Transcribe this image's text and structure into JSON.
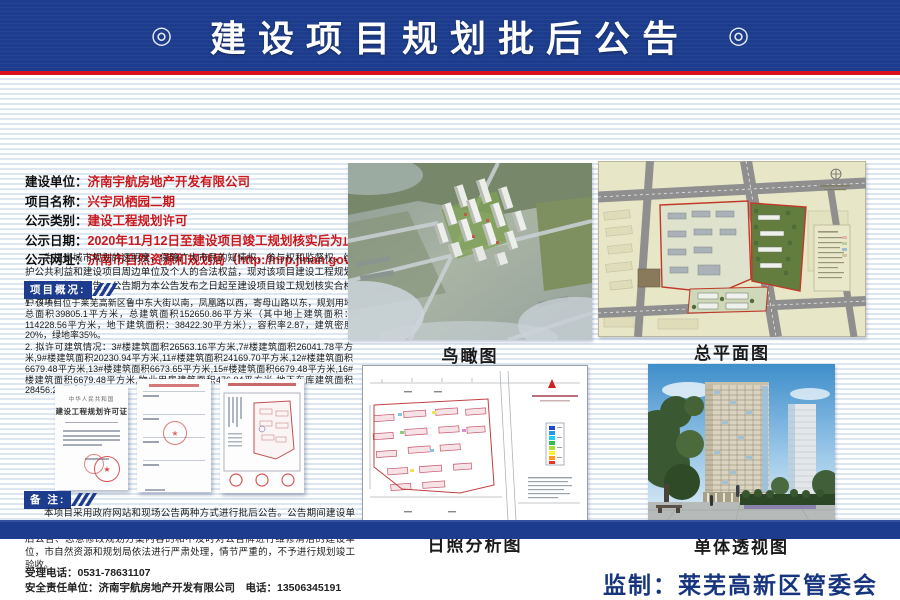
{
  "header": {
    "title": "建设项目规划批后公告",
    "ornament_left": "◎",
    "ornament_right": "◎"
  },
  "info": {
    "rows": [
      {
        "label": "建设单位：",
        "value": "济南宇航房地产开发有限公司"
      },
      {
        "label": "项目名称：",
        "value": "兴宇凤栖园二期"
      },
      {
        "label": "公示类别：",
        "value": "建设工程规划许可"
      },
      {
        "label": "公示日期：",
        "value": "2020年11月12日至建设项目竣工规划核实后为止"
      },
      {
        "label": "公示网址：",
        "value": "济南市自然资源和规划局（http://nrp.jinan.gov.cn）"
      }
    ],
    "intro": "为提高城市规划的透明度，保障广大市民的知情权，参与权和监督权，维护公共利益和建设项目周边单位及个人的合法权益，现对该项目建设工程规划许可进行批后公告，公告期为本公告发布之日起至建设项目竣工规划核实合格后为止。"
  },
  "overview": {
    "heading": "项目概况:",
    "item1": "1. 该项目位于莱芜高新区鲁中东大街以南，凤凰路以西，寄母山路以东，规划用地总面积39805.1平方米，总建筑面积152650.86平方米（其中地上建筑面积：114228.56平方米，地下建筑面积：38422.30平方米），容积率2.87，建筑密度20%，绿地率35%。",
    "item2": "2. 拟许可建筑情况：3#楼建筑面积26563.16平方米,7#楼建筑面积26041.78平方米,9#楼建筑面积20230.94平方米,11#楼建筑面积24169.70平方米,12#楼建筑面积6679.48平方米,13#楼建筑面积6673.65平方米,15#楼建筑面积6679.48平方米,16#楼建筑面积6679.48平方米,物业用房建筑面积476.94平方米,地下车库建筑面积28456.25平方米。"
  },
  "permits": {
    "cert_country": "中华人民共和国",
    "cert_title": "建设工程规划许可证"
  },
  "remarks": {
    "heading": "备 注:",
    "text": "本项目采用政府网站和现场公告两种方式进行批后公告。公告期间建设单位应保留公告牌清洁、完整，如有损坏应及时更换。对凡是不按照规定进行批后公告、恶意修改规划方案内容的和不及时对公告牌进行维修清洁的建设单位，市自然资源和规划局依法进行严肃处理，情节严重的，不予进行规划竣工验收。"
  },
  "contact": {
    "tel_line": "受理电话：0531-78631107",
    "safety_line": "安全责任单位：济南宇航房地产开发有限公司　电话：13506345191"
  },
  "figures": {
    "aerial_caption": "鸟瞰图",
    "siteplan_caption": "总平面图",
    "sunshine_caption": "日照分析图",
    "perspective_caption": "单体透视图"
  },
  "footer": {
    "supervision": "监制：莱芜高新区管委会"
  },
  "colors": {
    "navy": "#1d3c8d",
    "red_line": "#d8111d",
    "value_red": "#c9191d",
    "stripe_blue": "#dde7f2"
  }
}
